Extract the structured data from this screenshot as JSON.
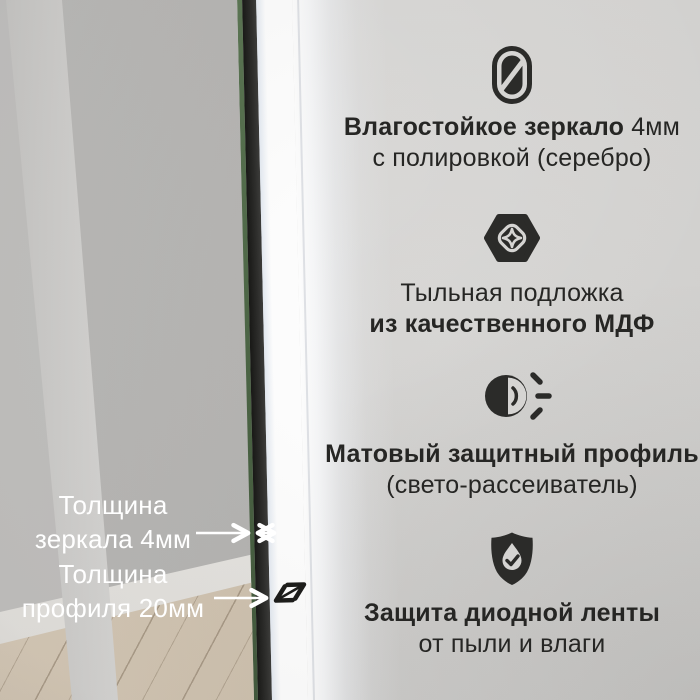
{
  "features": [
    {
      "icon": "mirror-icon",
      "line1_bold": "Влагостойкое зеркало",
      "line1_normal": " 4мм",
      "line2_bold": "",
      "line2_normal": "с полировкой (серебро)"
    },
    {
      "icon": "mdf-backing-icon",
      "line1_bold": "",
      "line1_normal": "Тыльная подложка",
      "line2_bold": "из качественного МДФ",
      "line2_normal": ""
    },
    {
      "icon": "light-diffuser-icon",
      "line1_bold": "Матовый защитный профиль",
      "line1_normal": "",
      "line2_bold": "",
      "line2_normal": "(свето-рассеиватель)"
    },
    {
      "icon": "shield-protection-icon",
      "line1_bold": "Защита диодной ленты",
      "line1_normal": "",
      "line2_bold": "",
      "line2_normal": "от пыли и влаги"
    }
  ],
  "callouts": [
    {
      "line1": "Толщина",
      "line2": "зеркала 4мм"
    },
    {
      "line1": "Толщина",
      "line2": "профиля 20мм"
    }
  ],
  "colors": {
    "text_dark": "#262624",
    "text_light": "#ffffff",
    "icon_ink": "#2b2b29",
    "glass_edge_green": "#4f6a47",
    "led_glow": "#ffffff",
    "wall": "#d5d4d2",
    "reflection_gray": "#b3b2b0",
    "floor_wood": "#cfc2af"
  }
}
